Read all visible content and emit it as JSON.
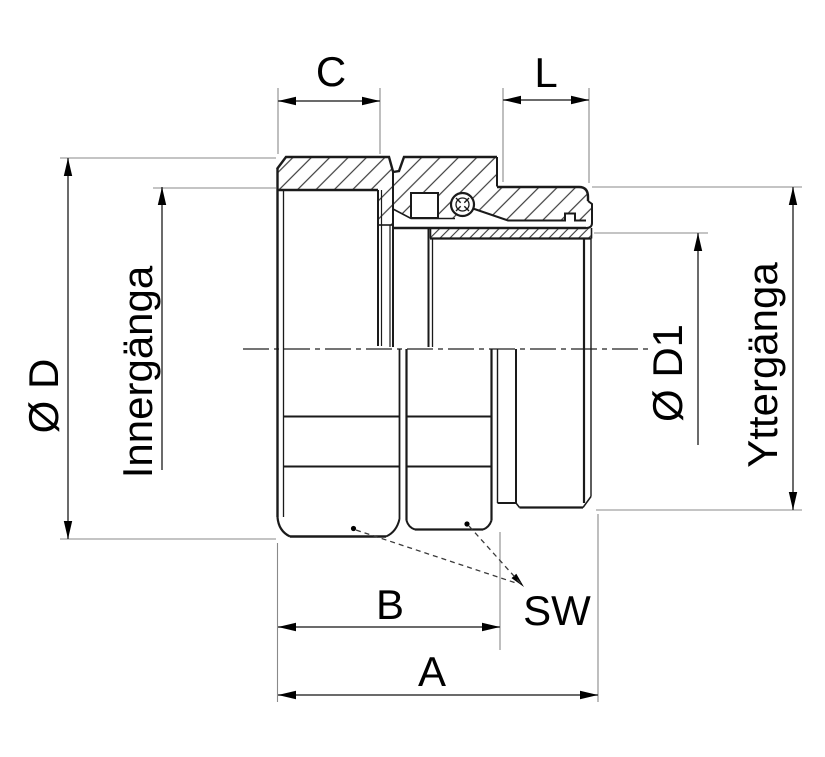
{
  "drawing": {
    "title": "threaded-coupling-cross-section",
    "labels": {
      "c": "C",
      "l": "L",
      "diameter_d": "Ø D",
      "inner_thread": "Innergänga",
      "diameter_d1": "Ø D1",
      "outer_thread": "Yttergänga",
      "b": "B",
      "sw": "SW",
      "a": "A"
    },
    "colors": {
      "outline": "#1a1a1a",
      "hatch": "#3c3c3c",
      "dimension_line": "#3a3a3a",
      "extension_line": "#8a8a8a",
      "arrow": "#000000",
      "background": "#ffffff"
    }
  }
}
